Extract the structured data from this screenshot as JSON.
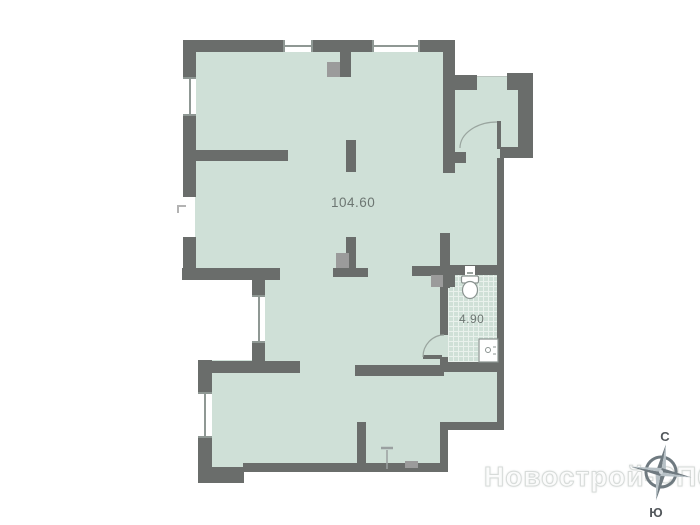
{
  "plan": {
    "main_area_label": "104.60",
    "bathroom_area_label": "4.90"
  },
  "compass": {
    "north_label": "С",
    "south_label": "Ю"
  },
  "watermark": {
    "text": "Новострой-СПб"
  },
  "colors": {
    "wall": "#6a6d6b",
    "floor_fill": "#cfe0d7",
    "tile_line": "#e9f1ec",
    "background": "#ffffff",
    "vent_gray": "#9b9b9b",
    "frame": "#8f9894",
    "label_text": "#6d7672",
    "compass_dark": "#6f7a80",
    "compass_light": "#b7c1c6",
    "door_arc": "#9aa59f"
  }
}
